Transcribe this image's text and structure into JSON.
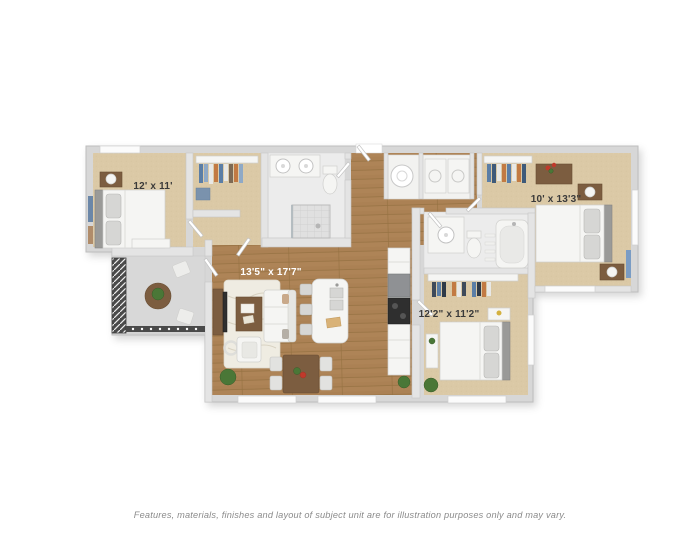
{
  "image": {
    "type": "3d-floor-plan-render",
    "background": "#ffffff"
  },
  "floorplan": {
    "rooms": [
      {
        "id": "bedroom-left",
        "label": "12' x 11'",
        "floor": "carpet"
      },
      {
        "id": "living-dining-kitchen",
        "label": "13'5\" x 17'7\"",
        "floor": "hardwood"
      },
      {
        "id": "bedroom-right",
        "label": "10' x 13'3\"",
        "floor": "carpet"
      },
      {
        "id": "bedroom-lower-right",
        "label": "12'2\" x 11'2\"",
        "floor": "carpet"
      }
    ],
    "features": [
      "balcony",
      "two bathrooms",
      "walk-in closets",
      "kitchen island",
      "in-unit laundry"
    ],
    "colors": {
      "hardwood": "#ab8154",
      "hardwood_line": "#93703f",
      "carpet": "#dbc9a6",
      "wall": "#dcdcdc",
      "wall_outline": "#bdbdbd",
      "tile": "#ececec",
      "balcony_floor": "#d8d8d8",
      "railing": "#4a4a4a",
      "label_dark": "#3a3a3a",
      "label_light": "#ffffff",
      "plant": "#4a7737",
      "wood_furniture": "#7c5d40",
      "accent_red": "#c0392b",
      "accent_blue": "#5b7ea6",
      "accent_orange": "#c27a43"
    }
  },
  "footer": {
    "disclaimer": "Features, materials, finishes and layout of subject unit are for illustration purposes only and may vary."
  }
}
